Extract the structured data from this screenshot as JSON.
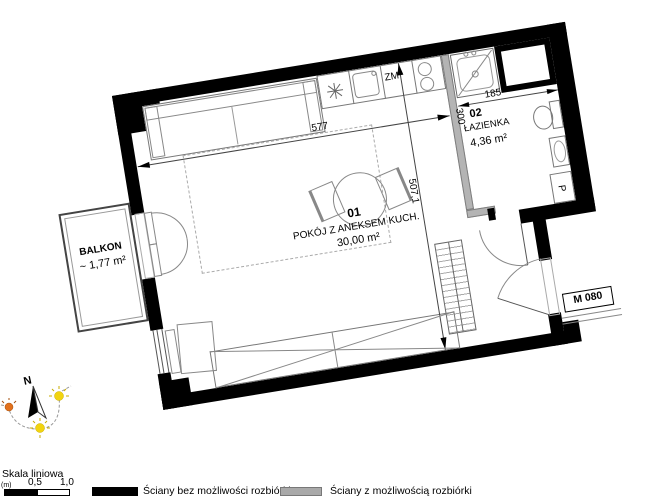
{
  "plan": {
    "rooms": {
      "main": {
        "number": "01",
        "name": "POKÓJ Z ANEKSEM KUCH.",
        "area": "30,00 m²"
      },
      "bathroom": {
        "number": "02",
        "name": "ŁAZIENKA",
        "area": "4,36 m²"
      },
      "balcony": {
        "name": "BALKON",
        "area": "~ 1,77 m²"
      }
    },
    "dimensions": {
      "room_width": "577",
      "room_height": "507,1",
      "bath_width": "185",
      "bath_height": "300"
    },
    "labels": {
      "apartment_id": "M 080",
      "dishwasher": "ZM",
      "washer": "P"
    },
    "compass": {
      "north": "N"
    }
  },
  "footer": {
    "scale": {
      "title": "Skala liniowa",
      "unit": "(m)",
      "tick_mid": "0,5",
      "tick_end": "1,0"
    },
    "legend": [
      {
        "swatch_color": "#000000",
        "label": "Ściany bez możliwości rozbiórki"
      },
      {
        "swatch_color": "#a9a9a9",
        "label": "Ściany z możliwością rozbiórki"
      }
    ]
  },
  "colors": {
    "wall": "#000000",
    "demolishable_wall": "#b4b4b4",
    "sun_yellow": "#f2d40e",
    "sun_orange": "#e2711d"
  }
}
